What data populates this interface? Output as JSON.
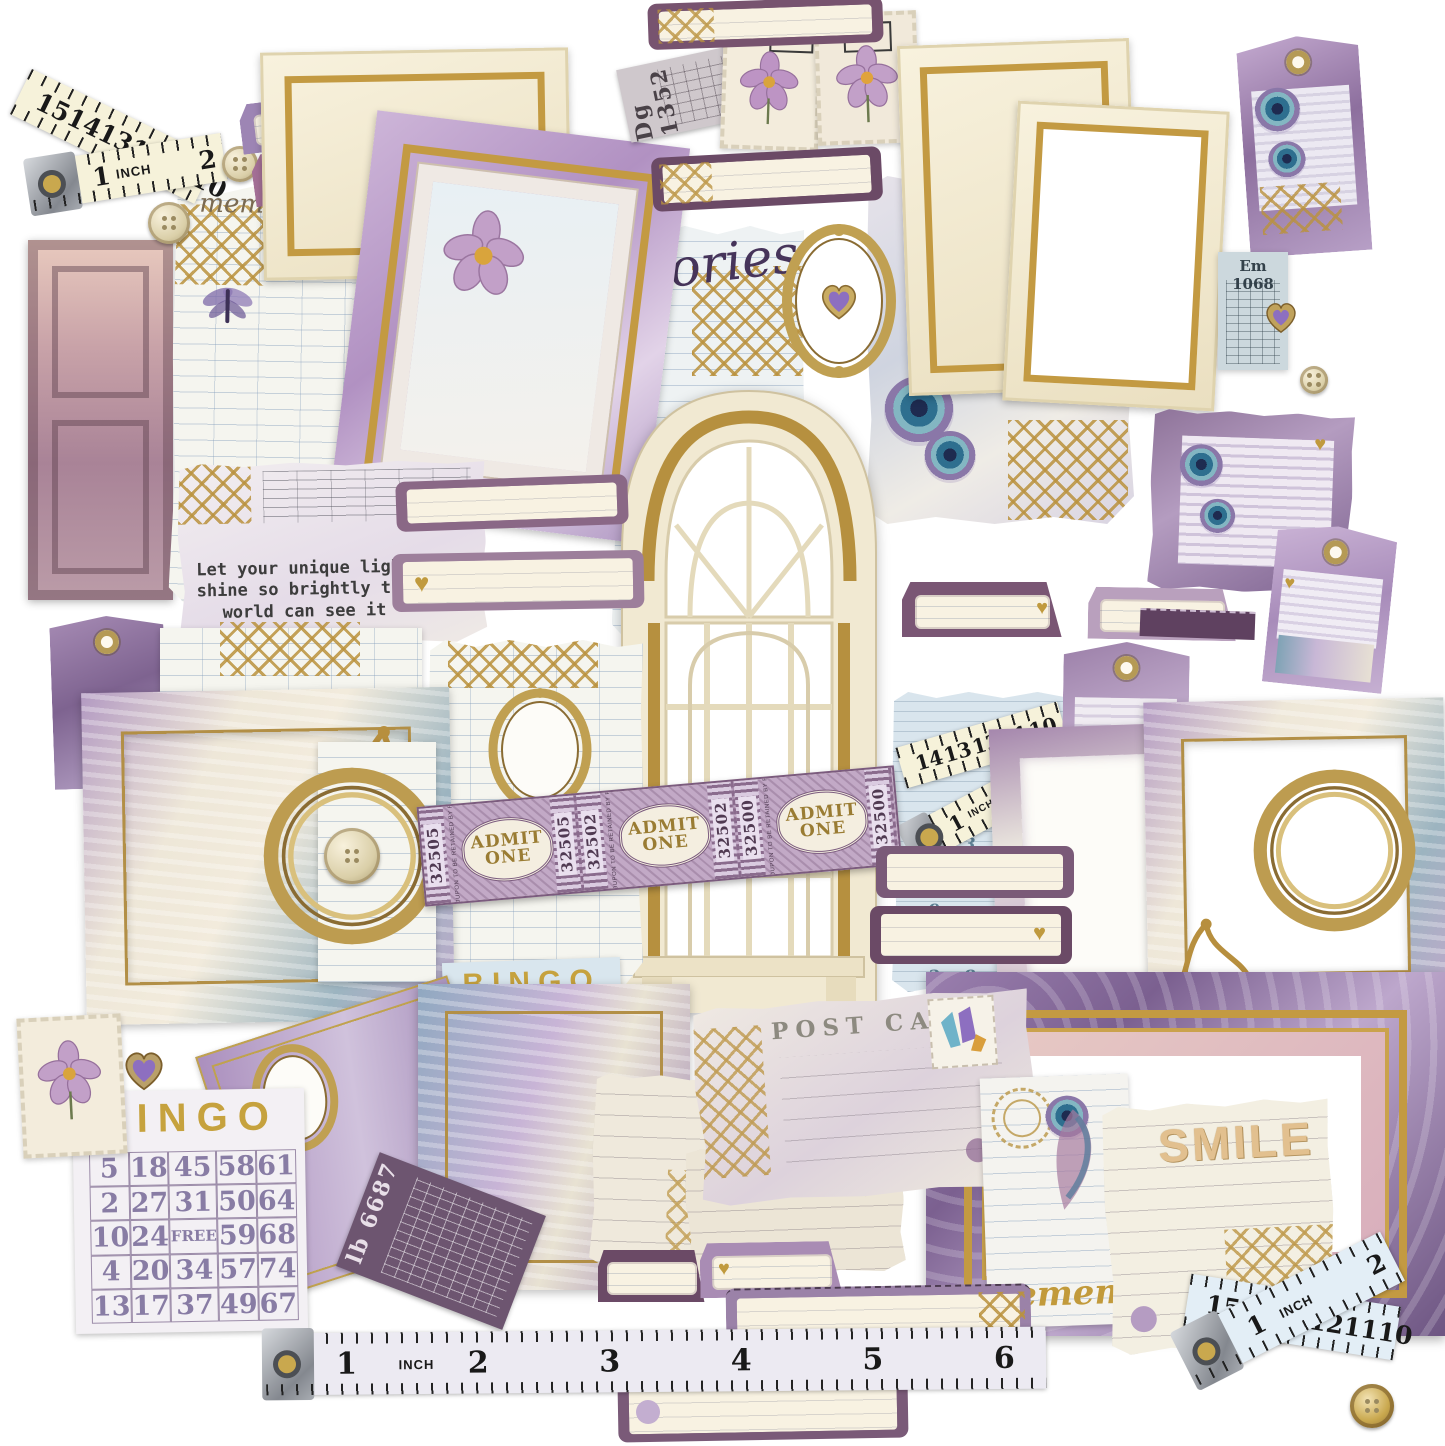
{
  "palette": {
    "gold": "#b68f3f",
    "purple_deep": "#6b4a68",
    "lavender": "#b9a6c9",
    "cream": "#f4efdc",
    "blue_paper": "#d9e6ee"
  },
  "quote": {
    "line1": "Let your unique light",
    "line2": "shine so brightly the",
    "line3": "world can see it"
  },
  "caption": {
    "memor": "memor",
    "caps": "MA",
    "the": "the",
    "script_word": "memories"
  },
  "tickets": {
    "dg": "Dg 1352",
    "em": "Em 1068",
    "lb": "lb 6687",
    "admit_line1": "ADMIT",
    "admit_line2": "ONE",
    "admit_numbers": [
      "32505",
      "32502",
      "32500"
    ],
    "admit_coupon": "THIS COUPON TO BE RETAINED BY PATRON"
  },
  "bingo_purple": {
    "title": "BINGO",
    "cells": [
      [
        "5",
        "18",
        "45",
        "58",
        "61"
      ],
      [
        "2",
        "27",
        "31",
        "50",
        "64"
      ],
      [
        "10",
        "24",
        "FREE",
        "59",
        "68"
      ],
      [
        "4",
        "20",
        "34",
        "57",
        "74"
      ],
      [
        "13",
        "17",
        "37",
        "49",
        "67"
      ]
    ]
  },
  "bingo_blue": {
    "title": "BINGO",
    "cells": [
      [
        "5",
        "20",
        "3",
        ""
      ],
      [
        "14",
        "26",
        "3",
        "50"
      ],
      [
        "7",
        "16",
        "F",
        "53"
      ],
      [
        "5",
        "28",
        "",
        "55"
      ],
      [
        "",
        "",
        "",
        "52"
      ]
    ]
  },
  "postcard": {
    "title": "POST CARD"
  },
  "cards": {
    "smile": "SMILE",
    "remember": "remember"
  },
  "rulers": {
    "inch_label": "INCH",
    "top_left_upper": [
      "15",
      "14",
      "13",
      "12",
      "11",
      "10"
    ],
    "top_left_lower": [
      "1",
      "2"
    ],
    "bottom_numbers": [
      "1",
      "2",
      "3",
      "4",
      "5",
      "6"
    ],
    "newsprint_upper": [
      "14",
      "13",
      "12",
      "11",
      "10"
    ],
    "newsprint_lower": [
      "1",
      "2"
    ],
    "bottom_right_upper": [
      "15",
      "14",
      "13",
      "12",
      "11",
      "10"
    ],
    "bottom_right_lower": [
      "1",
      "2"
    ]
  },
  "number_grid": [
    "1 3 5 7 9 6",
    "4 4 2 9 1 9",
    "7 6 4 1 6 7",
    "2 8 5 8 3 4",
    "9 5 7 6 8 3"
  ]
}
